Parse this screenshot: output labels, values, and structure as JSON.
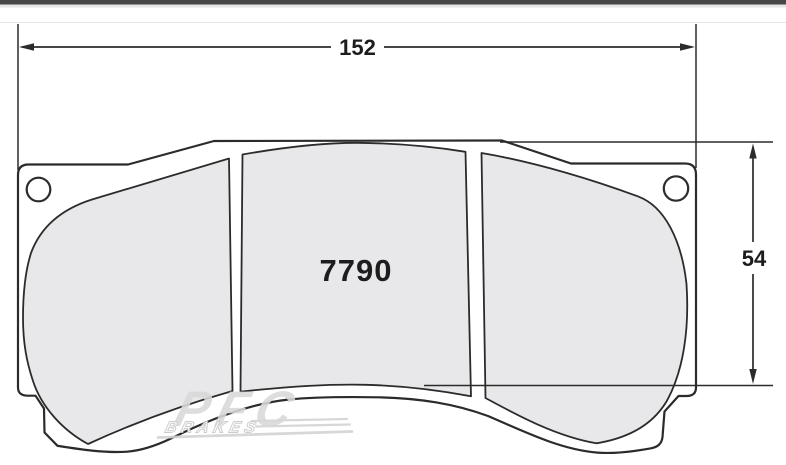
{
  "drawing": {
    "part_number": "7790",
    "dimensions": {
      "width_label": "152",
      "height_label": "54"
    },
    "watermark": {
      "brand": "PFC",
      "sub": "BRAKES"
    },
    "colors": {
      "line": "#2b2b2b",
      "plate_fill": "#ffffff",
      "friction_fill": "#e8e8ea",
      "top_bar": "#474747",
      "watermark_gray": "#d9d9d9",
      "watermark_stroke": "#c6c6c6",
      "swoosh_gray": "#d2d2d2"
    }
  }
}
